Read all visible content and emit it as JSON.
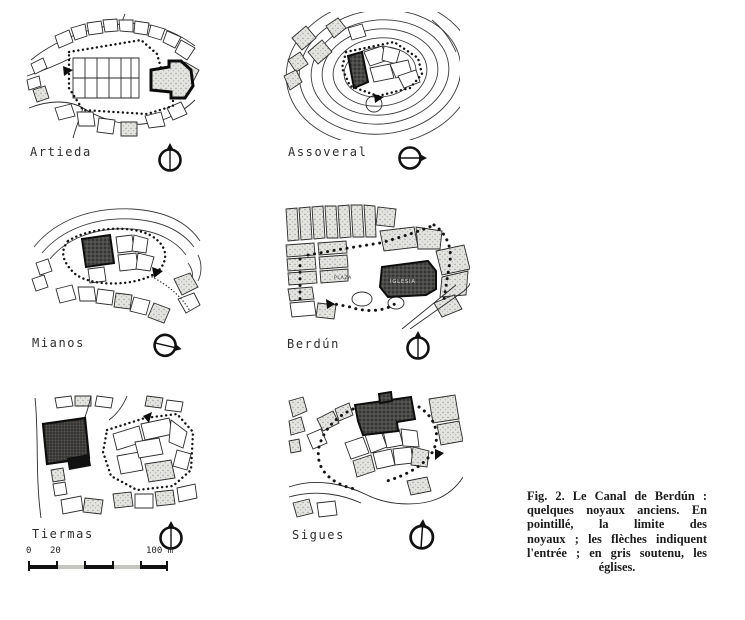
{
  "figure": {
    "panels": [
      {
        "name": "Artieda",
        "compass": "north-up"
      },
      {
        "name": "Assoveral",
        "compass": "north-right"
      },
      {
        "name": "Mianos",
        "compass": "north-right-tilted"
      },
      {
        "name": "Berdún",
        "compass": "north-up"
      },
      {
        "name": "Tiermas",
        "compass": "north-up"
      },
      {
        "name": "Sigues",
        "compass": "north-up-tilted"
      }
    ],
    "berdun_map_labels": {
      "plaza": "PLAZA",
      "iglesia": "IGLESIA"
    },
    "scale_bar": {
      "labels": [
        "0",
        "20",
        "100 m"
      ]
    },
    "caption": {
      "lines": [
        "Fig. 2. Le Canal de Berdún :",
        "quelques noyaux anciens. En",
        "pointillé, la limite des",
        "noyaux ; les flèches indiquent",
        "l'entrée ; en gris soutenu, les",
        "églises."
      ]
    },
    "colors": {
      "ink": "#1a1a1a",
      "church_fill": "#3a3a3a",
      "block_fill": "#e3e3e0",
      "paper": "#ffffff"
    }
  }
}
